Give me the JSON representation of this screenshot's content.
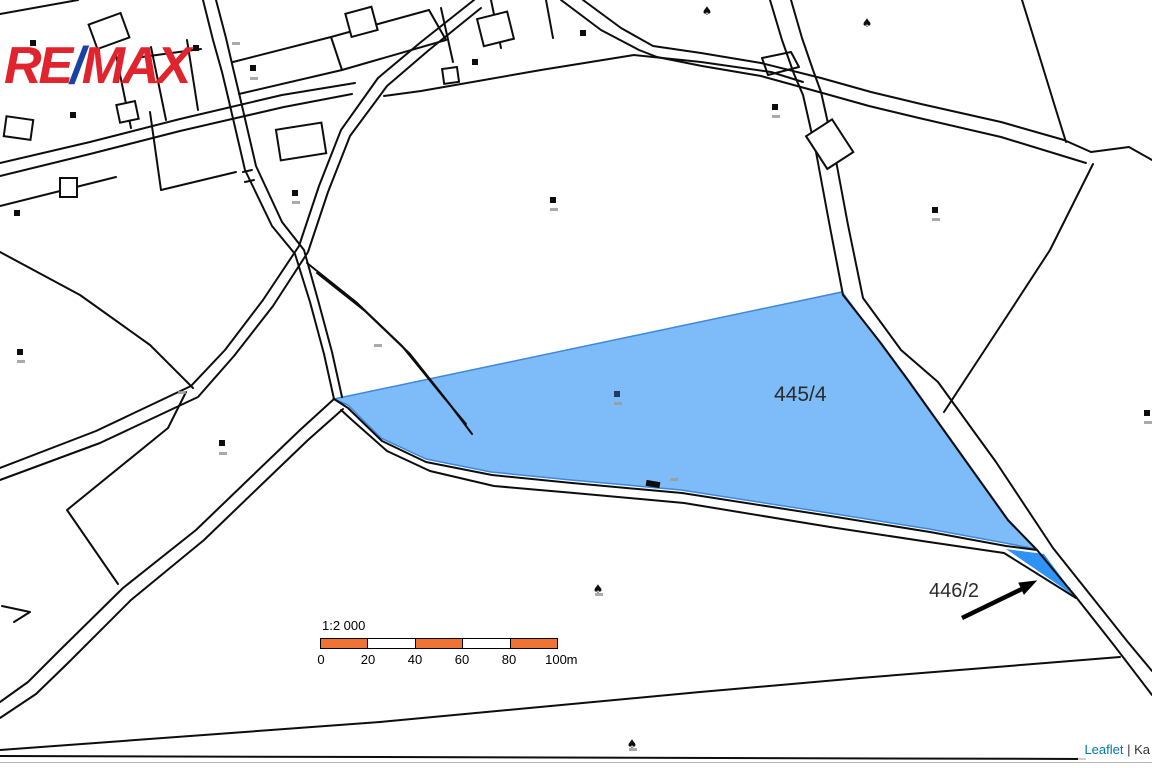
{
  "brand": {
    "re": "RE",
    "slash": "/",
    "max": "MAX",
    "red": "#e0232c",
    "blue": "#1843a5"
  },
  "parcels": {
    "p4454": {
      "label": "445/4",
      "fill": "#7dbcf9",
      "stroke": "#3c86dc"
    },
    "p4462": {
      "label": "446/2",
      "fill": "#2e93f4",
      "stroke": "#2573cc"
    }
  },
  "scale": {
    "ratio": "1:2 000",
    "ticks": [
      "0",
      "20",
      "40",
      "60",
      "80",
      "100"
    ],
    "unit": "m",
    "bar_colors": [
      "#ef7432",
      "#ffffff",
      "#ef7432",
      "#ffffff",
      "#ef7432"
    ]
  },
  "attribution": {
    "link": "Leaflet",
    "separator": " | ",
    "text": "Ka",
    "link_color": "#0078a8"
  },
  "map_symbols": {
    "squares": [
      [
        33,
        43
      ],
      [
        196,
        48
      ],
      [
        253,
        68
      ],
      [
        73,
        115
      ],
      [
        475,
        62
      ],
      [
        583,
        33
      ],
      [
        17,
        213
      ],
      [
        295,
        193
      ],
      [
        20,
        352
      ],
      [
        222,
        443
      ],
      [
        553,
        200
      ],
      [
        775,
        107
      ],
      [
        935,
        210
      ],
      [
        1147,
        413
      ]
    ],
    "dark_square": {
      "x": 617,
      "y": 394,
      "color": "#1d3d66"
    },
    "trees": [
      [
        707,
        15
      ],
      [
        867,
        27
      ],
      [
        598,
        593
      ],
      [
        632,
        748
      ]
    ],
    "micro_labels": [
      [
        30,
        52
      ],
      [
        250,
        77
      ],
      [
        292,
        201
      ],
      [
        219,
        452
      ],
      [
        550,
        208
      ],
      [
        932,
        218
      ],
      [
        1144,
        421
      ],
      [
        614,
        402
      ],
      [
        595,
        593
      ],
      [
        629,
        748
      ],
      [
        772,
        115
      ],
      [
        17,
        360
      ],
      [
        670,
        478
      ],
      [
        374,
        344
      ],
      [
        232,
        42
      ],
      [
        178,
        391
      ]
    ]
  }
}
